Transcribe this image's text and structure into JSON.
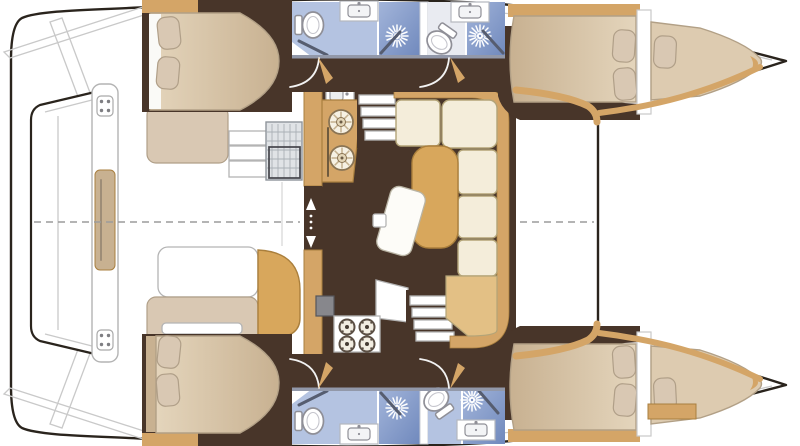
{
  "meta": {
    "title": "Catamaran yacht floor plan - overhead deck view",
    "type": "floor-plan",
    "orientation": "bow-right, stern-left, mirrored port/starboard hulls",
    "visible_text": "none"
  },
  "colors": {
    "outline": "#2a241d",
    "hullWhite": "#ffffff",
    "floorBrown": "#483529",
    "wood": "#d4a567",
    "woodEdge": "#a97f3f",
    "bedFill": "#ddcbb0",
    "bedEdge": "#b2a086",
    "bedLight": "#e4d5bc",
    "bedDark": "#c8b191",
    "pillowFill": "#d9c8b3",
    "pillowEdge": "#b09f88",
    "cream": "#f4edda",
    "creamEdge": "#b3a478",
    "chaise": "#e3c085",
    "tableTan": "#d8a75c",
    "tableEdge": "#aa7f3c",
    "bathFloor": "#b4c3e1",
    "bathFloorPale": "#e9ebf1",
    "showerA": "#a3b5da",
    "showerB": "#7089bd",
    "wallGray": "#9298a9",
    "hatchFill": "#e0e3e6",
    "hatchLine": "#aab0b6",
    "stepEdge": "#b4b4b4",
    "arcWhite": "#f2f2f2",
    "dashGray": "#9c9c9c",
    "sheerGray": "#c9c9c9",
    "doorDark": "#565d70",
    "metal": "#8f8f97",
    "burstCore": "#7b8fc0"
  },
  "plan": {
    "stern_area": {
      "platform": "transom platform between hulls",
      "crossbeam": "aft crossbeam with two cleats and center step pad"
    },
    "cockpit": {
      "items": [
        "bench-port",
        "steps",
        "fridge-hatch",
        "table",
        "bench-starboard"
      ]
    },
    "salon": {
      "entry": "sliding-door with direction arrows",
      "galley": [
        "sink-unit",
        "twin-round-sinks",
        "oven",
        "four-burner-stove",
        "prep-counter"
      ],
      "stairs": [
        "companionway-port",
        "companionway-starboard"
      ],
      "dinette": [
        "l-shaped-sofa",
        "chaise",
        "dining-table",
        "bench-seat",
        "table-leg"
      ]
    },
    "port_hull": {
      "rooms": [
        "aft-cabin-double-bed",
        "bathroom-aft (toilet, sink, shower)",
        "bathroom-fwd (toilet, sink, shower)",
        "fwd-cabin-double-bed",
        "forepeak-berth"
      ]
    },
    "starboard_hull": {
      "rooms": [
        "aft-cabin-double-bed",
        "bathroom-aft (toilet, sink, shower)",
        "bathroom-fwd (toilet, sink, shower)",
        "fwd-cabin-double-bed",
        "forepeak-berth"
      ]
    },
    "symbols": [
      "shower-jet-icon",
      "toilet-icon",
      "sink-icon",
      "burner-icon",
      "cleat-icon",
      "centerline-dashed"
    ]
  }
}
